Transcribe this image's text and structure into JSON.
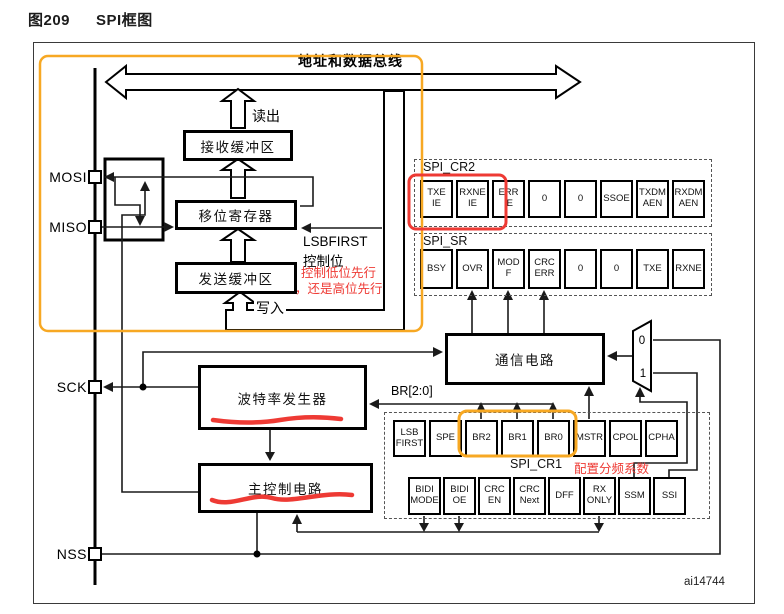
{
  "figure": {
    "number": "图209",
    "title": "SPI框图",
    "artifact": "ai14744"
  },
  "bus": {
    "label": "地址和数据总线",
    "read_label": "读出",
    "write_label": "写入"
  },
  "pins": {
    "mosi": "MOSI",
    "miso": "MISO",
    "sck": "SCK",
    "nss": "NSS"
  },
  "blocks": {
    "rx_buffer": "接收缓冲区",
    "shift_register": "移位寄存器",
    "tx_buffer": "发送缓冲区",
    "baud_gen": "波特率发生器",
    "comm_circuit": "通信电路",
    "master_ctrl": "主控制电路"
  },
  "labels": {
    "lsbfirst_line1": "LSBFIRST",
    "lsbfirst_line2": "控制位",
    "br_bits": "BR[2:0]",
    "reg_cr2": "SPI_CR2",
    "reg_sr": "SPI_SR",
    "reg_cr1": "SPI_CR1",
    "mux0": "0",
    "mux1": "1"
  },
  "annotations": {
    "lsb_note_line1": "控制低位先行",
    "lsb_note_line2": "，还是高位先行",
    "br_note": "配置分频系数",
    "red_color": "#ee3a34",
    "orange_color": "#f7a823"
  },
  "registers": {
    "cr2_bits": [
      [
        "TXE",
        "IE"
      ],
      [
        "RXNE",
        "IE"
      ],
      [
        "ERR",
        "IE"
      ],
      [
        "0"
      ],
      [
        "0"
      ],
      [
        "SSOE"
      ],
      [
        "TXDM",
        "AEN"
      ],
      [
        "RXDM",
        "AEN"
      ]
    ],
    "sr_bits": [
      [
        "BSY"
      ],
      [
        "OVR"
      ],
      [
        "MOD",
        "F"
      ],
      [
        "CRC",
        "ERR"
      ],
      [
        "0"
      ],
      [
        "0"
      ],
      [
        "TXE"
      ],
      [
        "RXNE"
      ]
    ],
    "cr1_row1": [
      [
        "LSB",
        "FIRST"
      ],
      [
        "SPE"
      ],
      [
        "BR2"
      ],
      [
        "BR1"
      ],
      [
        "BR0"
      ],
      [
        "MSTR"
      ],
      [
        "CPOL"
      ],
      [
        "CPHA"
      ]
    ],
    "cr1_row2": [
      [
        "BIDI",
        "MODE"
      ],
      [
        "BIDI",
        "OE"
      ],
      [
        "CRC",
        "EN"
      ],
      [
        "CRC",
        "Next"
      ],
      [
        "DFF"
      ],
      [
        "RX",
        "ONLY"
      ],
      [
        "SSM"
      ],
      [
        "SSI"
      ]
    ]
  }
}
